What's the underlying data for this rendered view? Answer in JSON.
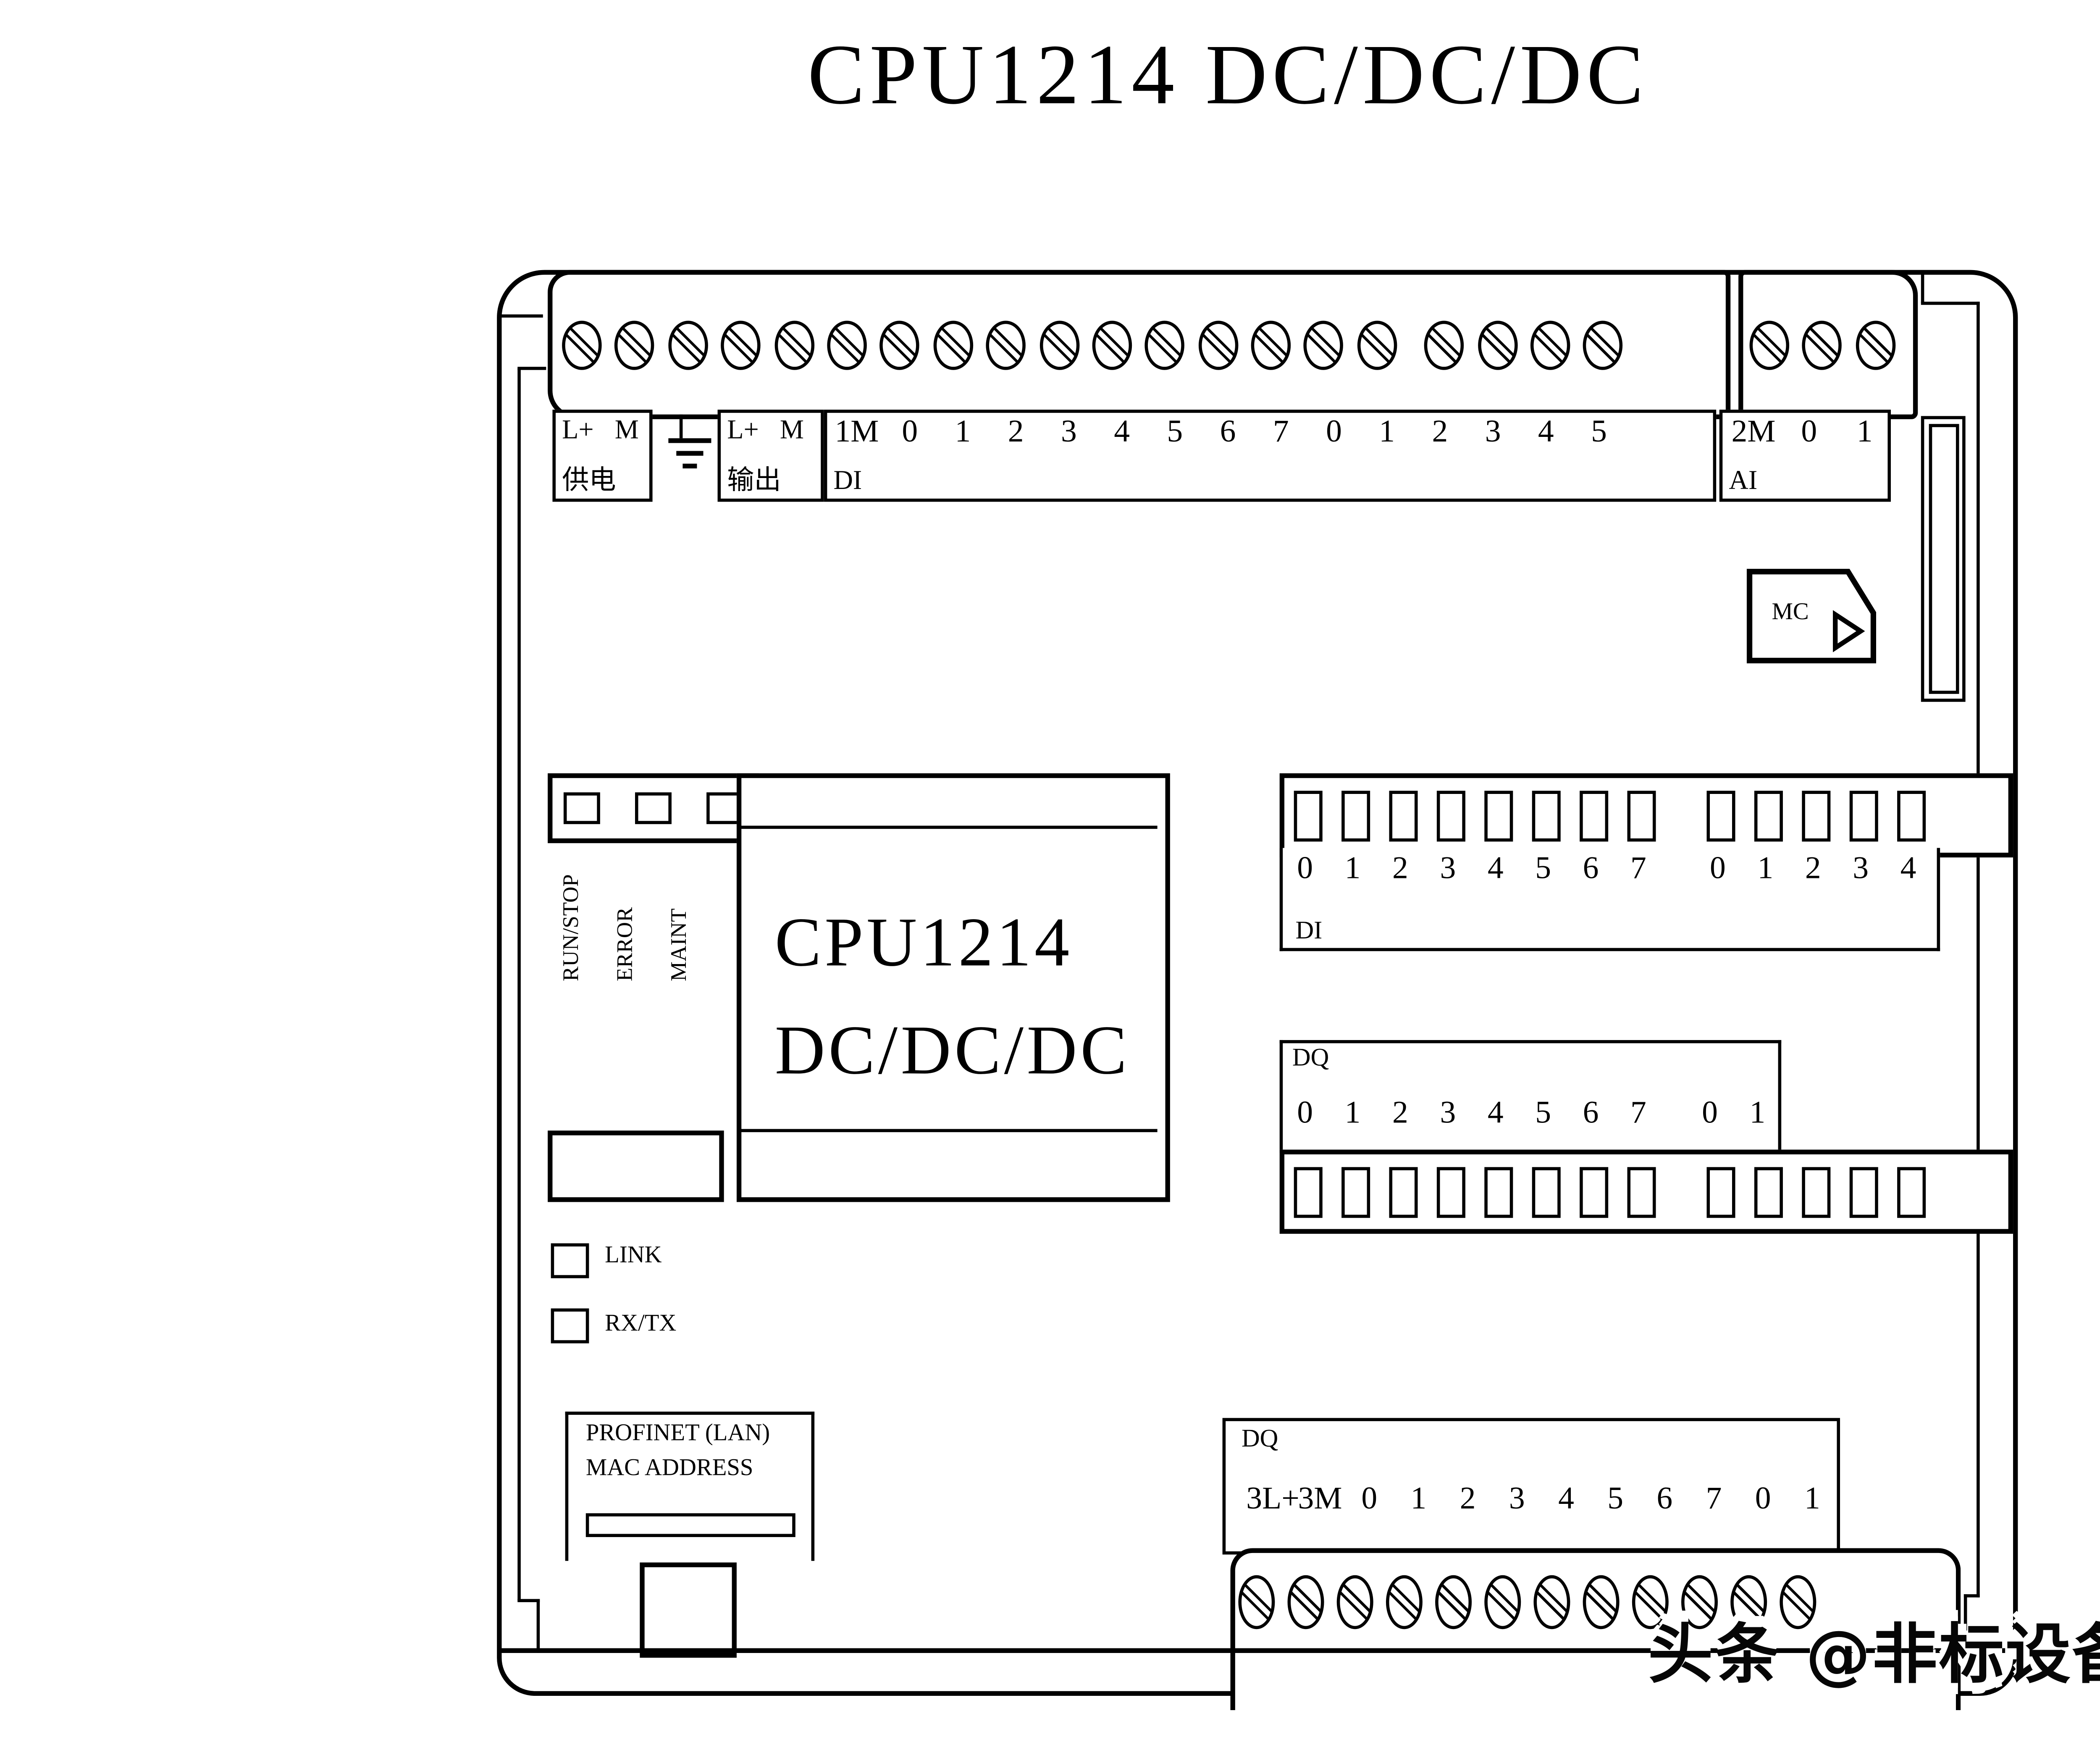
{
  "title": "CPU1214 DC/DC/DC",
  "module": {
    "name_line1": "CPU1214",
    "name_line2": "DC/DC/DC"
  },
  "top_labels": {
    "power": {
      "terminals": "L+ M",
      "caption": "供电"
    },
    "output": {
      "terminals": "L+ M",
      "caption": "输出"
    },
    "di": {
      "caption": "DI",
      "pins": [
        "1M",
        "0",
        "1",
        "2",
        "3",
        "4",
        "5",
        "6",
        "7",
        "0",
        "1",
        "2",
        "3",
        "4",
        "5"
      ]
    },
    "ai": {
      "caption": "AI",
      "pins": [
        "2M",
        "0",
        "1"
      ]
    }
  },
  "memory_card": {
    "label": "MC"
  },
  "status_leds": {
    "run_stop": "RUN/STOP",
    "error": "ERROR",
    "maint": "MAINT"
  },
  "di_panel": {
    "caption": "DI",
    "pins": [
      "0",
      "1",
      "2",
      "3",
      "4",
      "5",
      "6",
      "7",
      "0",
      "1",
      "2",
      "3",
      "4"
    ]
  },
  "dq_panel": {
    "caption": "DQ",
    "pins": [
      "0",
      "1",
      "2",
      "3",
      "4",
      "5",
      "6",
      "7",
      "0",
      "1"
    ]
  },
  "ethernet": {
    "link": "LINK",
    "rxtx": "RX/TX",
    "port_line1": "PROFINET (LAN)",
    "port_line2": "MAC ADDRESS"
  },
  "dq_bottom": {
    "caption": "DQ",
    "pins": [
      "3L+",
      "3M",
      "0",
      "1",
      "2",
      "3",
      "4",
      "5",
      "6",
      "7",
      "0",
      "1"
    ]
  },
  "watermark": "头条 @非标设备自动化设计",
  "colors": {
    "ink": "#000000",
    "paper": "#ffffff"
  }
}
